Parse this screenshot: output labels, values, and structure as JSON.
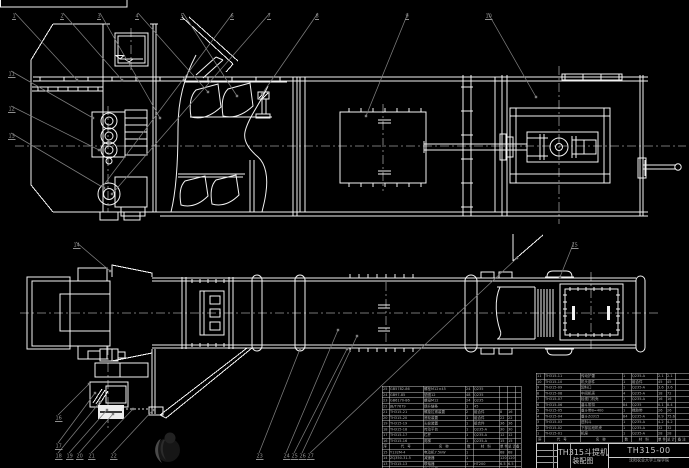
{
  "drawing": {
    "model": "TH315",
    "colors": {
      "background": "#000000",
      "line": "#f2f2f2",
      "leader": "#7d7d7d",
      "centerline": "#9a9a9a",
      "table_line": "#c9c9c9",
      "table_text": "#b6b6b6",
      "watermark_body": "#1b1b1b",
      "watermark_edge": "#4a4a4a"
    }
  },
  "title_block": {
    "product": "TH315斗提机",
    "sheet_name": "装配图",
    "drawing_no": "TH315-00",
    "org": "沈阳农业大学工程学院"
  },
  "bom_right": {
    "headers": [
      "序",
      "代  号",
      "名  称",
      "数",
      "材  料",
      "单件",
      "总计",
      "备注"
    ],
    "rows": [
      [
        "11",
        "TH315-11",
        "传动护罩",
        "1",
        "Q235-A",
        "2.1",
        "2.1",
        ""
      ],
      [
        "10",
        "TH315-10",
        "机头部件",
        "1",
        "组合件",
        "45",
        "45",
        ""
      ],
      [
        "9",
        "TH315-09",
        "卸料口",
        "1",
        "Q235-A",
        "3.6",
        "3.6",
        ""
      ],
      [
        "8",
        "TH315-08",
        "中间机壳",
        "4",
        "Q235-A",
        "18",
        "72",
        ""
      ],
      [
        "7",
        "TH315-07",
        "检视门机壳",
        "1",
        "Q235-A",
        "16",
        "16",
        ""
      ],
      [
        "6",
        "TH315-06",
        "畚斗带扣",
        "84",
        "Q235",
        "0.1",
        "8.4",
        ""
      ],
      [
        "5",
        "TH315-05",
        "畚斗带B=400",
        "1",
        "橡胶带",
        "26",
        "26",
        ""
      ],
      [
        "4",
        "TH315-04",
        "畚斗Zd315",
        "84",
        "Q235-A",
        "0.9",
        "75.6",
        ""
      ],
      [
        "3",
        "TH315-03",
        "进料斗",
        "1",
        "Q235-A",
        "4.2",
        "4.2",
        ""
      ],
      [
        "2",
        "TH315-02",
        "下部区段机壳",
        "1",
        "Q235-A",
        "32",
        "32",
        ""
      ],
      [
        "1",
        "TH315-01",
        "机座",
        "1",
        "Q235-A",
        "28",
        "28",
        ""
      ]
    ]
  },
  "bom_left": {
    "rows_upper": [
      [
        "25",
        "GB5782-86",
        "螺栓M12×45",
        "24",
        "Q235",
        "",
        "",
        ""
      ],
      [
        "24",
        "GB97-85",
        "垫圈12",
        "48",
        "Q235",
        "",
        "",
        ""
      ],
      [
        "23",
        "GB6170-86",
        "螺母M12",
        "24",
        "Q235",
        "",
        "",
        ""
      ],
      [
        "22",
        "JB/T7679",
        "提升链条",
        "1",
        "45",
        "",
        "",
        ""
      ],
      [
        "21",
        "TH315-21",
        "螺旋拉紧装置",
        "2",
        "组合件",
        "8",
        "16",
        ""
      ],
      [
        "20",
        "TH315-20",
        "底轮装置",
        "1",
        "组合件",
        "22",
        "22",
        ""
      ],
      [
        "19",
        "TH315-19",
        "头轮装置",
        "1",
        "组合件",
        "36",
        "36",
        ""
      ],
      [
        "18",
        "TH315-18",
        "传动平台",
        "1",
        "Q235-A",
        "30",
        "30",
        ""
      ],
      [
        "17",
        "TH315-17",
        "栏杆",
        "1",
        "Q235-A",
        "12",
        "12",
        ""
      ],
      [
        "16",
        "TH315-16",
        "爬梯",
        "1",
        "Q235-A",
        "15",
        "15",
        ""
      ]
    ],
    "headers": [
      "序",
      "代  号",
      "名  称",
      "数",
      "材  料",
      "单件",
      "总计",
      "备注"
    ],
    "rows_lower": [
      [
        "15",
        "Y132M-4",
        "电动机7.5kW",
        "1",
        "",
        "68",
        "68",
        ""
      ],
      [
        "14",
        "ZQ350-31.5",
        "减速器",
        "1",
        "",
        "120",
        "120",
        ""
      ],
      [
        "13",
        "TH315-13",
        "联轴器",
        "1",
        "HT200",
        "6.5",
        "6.5",
        ""
      ],
      [
        "12",
        "TH315-12",
        "逆止装置",
        "1",
        "",
        "3.2",
        "3.2",
        ""
      ]
    ]
  },
  "callouts": [
    {
      "n": "1",
      "bx": 12,
      "by": 8,
      "tx": 77,
      "ty": 80
    },
    {
      "n": "2",
      "bx": 60,
      "by": 8,
      "tx": 122,
      "ty": 80
    },
    {
      "n": "3",
      "bx": 97,
      "by": 8,
      "tx": 160,
      "ty": 118
    },
    {
      "n": "4",
      "bx": 135,
      "by": 8,
      "tx": 208,
      "ty": 92
    },
    {
      "n": "5",
      "bx": 180,
      "by": 8,
      "tx": 237,
      "ty": 96
    },
    {
      "n": "6",
      "bx": 230,
      "by": 8,
      "tx": 103,
      "ty": 186
    },
    {
      "n": "7",
      "bx": 267,
      "by": 8,
      "tx": 112,
      "ty": 194
    },
    {
      "n": "8",
      "bx": 315,
      "by": 8,
      "tx": 262,
      "ty": 94
    },
    {
      "n": "9",
      "bx": 405,
      "by": 8,
      "tx": 366,
      "ty": 116
    },
    {
      "n": "10",
      "bx": 485,
      "by": 8,
      "tx": 536,
      "ty": 97
    },
    {
      "n": "11",
      "bx": 8,
      "by": 66,
      "tx": 93,
      "ty": 118
    },
    {
      "n": "12",
      "bx": 8,
      "by": 101,
      "tx": 99,
      "ty": 150
    },
    {
      "n": "13",
      "bx": 8,
      "by": 128,
      "tx": 104,
      "ty": 188
    },
    {
      "n": "14",
      "bx": 73,
      "by": 237,
      "tx": 110,
      "ty": 271
    },
    {
      "n": "15",
      "bx": 571,
      "by": 237,
      "tx": 560,
      "ty": 277
    },
    {
      "n": "16",
      "bx": 55,
      "by": 410,
      "tx": 89,
      "ty": 384
    },
    {
      "n": "17",
      "bx": 55,
      "by": 438,
      "tx": 95,
      "ty": 393
    },
    {
      "n": "18",
      "bx": 55,
      "by": 448,
      "tx": 100,
      "ty": 402
    },
    {
      "n": "19",
      "bx": 66,
      "by": 448,
      "tx": 107,
      "ty": 410
    },
    {
      "n": "20",
      "bx": 76,
      "by": 448,
      "tx": 113,
      "ty": 414
    },
    {
      "n": "21",
      "bx": 88,
      "by": 448,
      "tx": 133,
      "ty": 409
    },
    {
      "n": "22",
      "bx": 110,
      "by": 448,
      "tx": 153,
      "ty": 410
    },
    {
      "n": "23",
      "bx": 256,
      "by": 448,
      "tx": 300,
      "ty": 349
    },
    {
      "n": "24",
      "bx": 283,
      "by": 448,
      "tx": 338,
      "ty": 330
    },
    {
      "n": "25",
      "bx": 291,
      "by": 448,
      "tx": 347,
      "ty": 349
    },
    {
      "n": "26",
      "bx": 299,
      "by": 448,
      "tx": 357,
      "ty": 336
    },
    {
      "n": "27",
      "bx": 307,
      "by": 448,
      "tx": 517,
      "ty": 258
    }
  ]
}
